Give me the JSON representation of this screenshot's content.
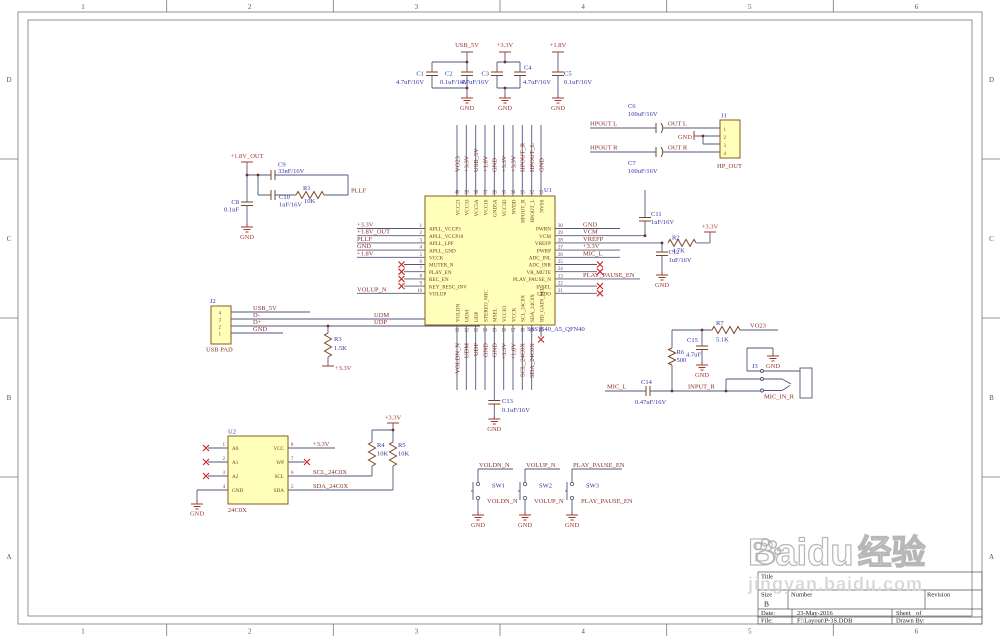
{
  "frame": {
    "cols": [
      "1",
      "2",
      "3",
      "4",
      "5",
      "6"
    ],
    "rows": [
      "D",
      "C",
      "B",
      "A"
    ]
  },
  "nets": {
    "usb5v": "USB_5V",
    "p33": "+3.3V",
    "p18": "+1.8V",
    "p18out": "+1.8V_OUT",
    "gnd": "GND",
    "pllf": "PLLF",
    "volupn": "VOLUP_N",
    "voldnn": "VOLDN_N",
    "playpause": "PLAY_PAUSE_EN",
    "micl": "MIC_L",
    "inputr": "INPUT_R",
    "vo23": "VO23",
    "udm": "UDM",
    "udp": "UDP",
    "dm": "D-",
    "dp": "D+",
    "hpl": "HPOUT L",
    "hpr": "HPOUT R",
    "outl": "OUT L",
    "outr": "OUT R",
    "scl": "SCL_24C0X",
    "sda": "SDA_24C0X",
    "micinr": "MIC_IN_R"
  },
  "parts": {
    "c1": {
      "ref": "C1",
      "val": "4.7uF/16V"
    },
    "c2": {
      "ref": "C2",
      "val": "0.1uF/16V"
    },
    "c3": {
      "ref": "C3",
      "val": "4.7uF/16V"
    },
    "c4": {
      "ref": "C4",
      "val": "4.7uF/16V"
    },
    "c5": {
      "ref": "C5",
      "val": "0.1uF/16V"
    },
    "c6": {
      "ref": "C6",
      "val": "100uF/16V"
    },
    "c7": {
      "ref": "C7",
      "val": "100uF/16V"
    },
    "c8": {
      "ref": "C8",
      "val": "0.1uF"
    },
    "c9": {
      "ref": "C9",
      "val": "33nF/16V"
    },
    "c10": {
      "ref": "C10",
      "val": "1uF/16V"
    },
    "c11": {
      "ref": "C11",
      "val": "1uF/16V"
    },
    "c12": {
      "ref": "C12",
      "val": "1uF/16V"
    },
    "c13": {
      "ref": "C13",
      "val": "0.1uF/16V"
    },
    "c14": {
      "ref": "C14",
      "val": "0.47uF/16V"
    },
    "c15": {
      "ref": "C15",
      "val": "4.7uF"
    },
    "r1": {
      "ref": "R1",
      "val": "10K"
    },
    "r2": {
      "ref": "R2",
      "val": "4.7K"
    },
    "r3": {
      "ref": "R3",
      "val": "1.5K"
    },
    "r4": {
      "ref": "R4",
      "val": "10K"
    },
    "r5": {
      "ref": "R5",
      "val": "10K"
    },
    "r6": {
      "ref": "R6",
      "val": "500"
    },
    "r7": {
      "ref": "R7",
      "val": "5.1K"
    }
  },
  "u1": {
    "ref": "U1",
    "part": "SSS1540_A5_QFN40",
    "left_names": [
      "APLL_VCCP3",
      "APLL_VCCP18",
      "APLL_LPF",
      "APLL_GND",
      "VCCK",
      "MUTER_N",
      "PLAY_EN",
      "REC_EN",
      "KEY_RESC_INV",
      "VOLUP"
    ],
    "right_names": [
      "PWRN",
      "VCM",
      "VREFP",
      "PWRP",
      "ADC_INL",
      "ADC_INR",
      "VR_MUTE",
      "PLAY_PAUSE_N",
      "INSEL",
      "LEDO"
    ],
    "top_names": [
      "VCC23",
      "VCC33",
      "VCC5A",
      "VCC18",
      "GND5A",
      "VCC3D",
      "NVDD",
      "HPOUT_R",
      "HPOUT_L",
      "NVSS"
    ],
    "bottom_names": [
      "VOLDN",
      "UDM",
      "UDP",
      "STEREO_MIC",
      "MSEL",
      "VCCIO",
      "VCCK",
      "SCL_24C0X",
      "SDA_24C0X",
      "HD_GAIN_SEL"
    ],
    "left_nums": [
      "1",
      "2",
      "3",
      "4",
      "5",
      "6",
      "7",
      "8",
      "9",
      "10"
    ],
    "right_nums": [
      "30",
      "29",
      "28",
      "27",
      "26",
      "25",
      "24",
      "23",
      "22",
      "21"
    ],
    "top_nums": [
      "40",
      "39",
      "38",
      "37",
      "36",
      "35",
      "34",
      "33",
      "32",
      "31"
    ],
    "bottom_nums": [
      "11",
      "12",
      "13",
      "14",
      "15",
      "16",
      "17",
      "18",
      "19",
      "20"
    ],
    "left_nets": [
      "+3.3V",
      "+1.8V_OUT",
      "PLLF",
      "GND",
      "+1.8V",
      "",
      "",
      "",
      "",
      "VOLUP_N"
    ],
    "right_nets": [
      "GND",
      "VCM",
      "VREFP",
      "+3.3V",
      "MIC_L",
      "",
      "",
      "PLAY_PAUSE_EN",
      "",
      ""
    ],
    "top_nets": [
      "VO23",
      "+3.3V",
      "USB_5V",
      "+1.8V",
      "GND",
      "+3.3V",
      "+3.3V",
      "HPOUT_R",
      "HPOUT_L",
      "GND"
    ],
    "bottom_nets": [
      "VOLDN_N",
      "UDM",
      "UDP",
      "GND",
      "GND",
      "+3.3V",
      "+1.8V",
      "SCL_24C0X",
      "SDA_24C0X",
      ""
    ]
  },
  "u2": {
    "ref": "U2",
    "part": "24C0X",
    "left_names": [
      "A0",
      "A1",
      "A2",
      "GND"
    ],
    "right_names": [
      "VCC",
      "WP",
      "SCL",
      "SDA"
    ],
    "left_nums": [
      "1",
      "2",
      "3",
      "4"
    ],
    "right_nums": [
      "8",
      "7",
      "6",
      "5"
    ]
  },
  "j1": {
    "ref": "J1",
    "name": "HP_OUT",
    "pins": [
      "1",
      "2",
      "3",
      "4"
    ]
  },
  "j2": {
    "ref": "J2",
    "name": "USB PAD",
    "pins": [
      "4",
      "3",
      "2",
      "1"
    ]
  },
  "j3": {
    "ref": "J3"
  },
  "switches": {
    "sw1": {
      "ref": "SW1"
    },
    "sw2": {
      "ref": "SW2"
    },
    "sw3": {
      "ref": "SW3"
    }
  },
  "title_block": {
    "title_label": "Title",
    "size_label": "Size",
    "size": "B",
    "number_label": "Number",
    "revision_label": "Revision",
    "date_label": "Date:",
    "date": "23-May-2016",
    "sheet_label": "Sheet",
    "of_label": "of",
    "file_label": "File:",
    "file": "F:\\Layout\\P-3S.DDB",
    "drawn_label": "Drawn By:"
  },
  "watermark": {
    "brand": "Baidu",
    "brand_cn": "经验",
    "url": "jingyan.baidu.com"
  }
}
